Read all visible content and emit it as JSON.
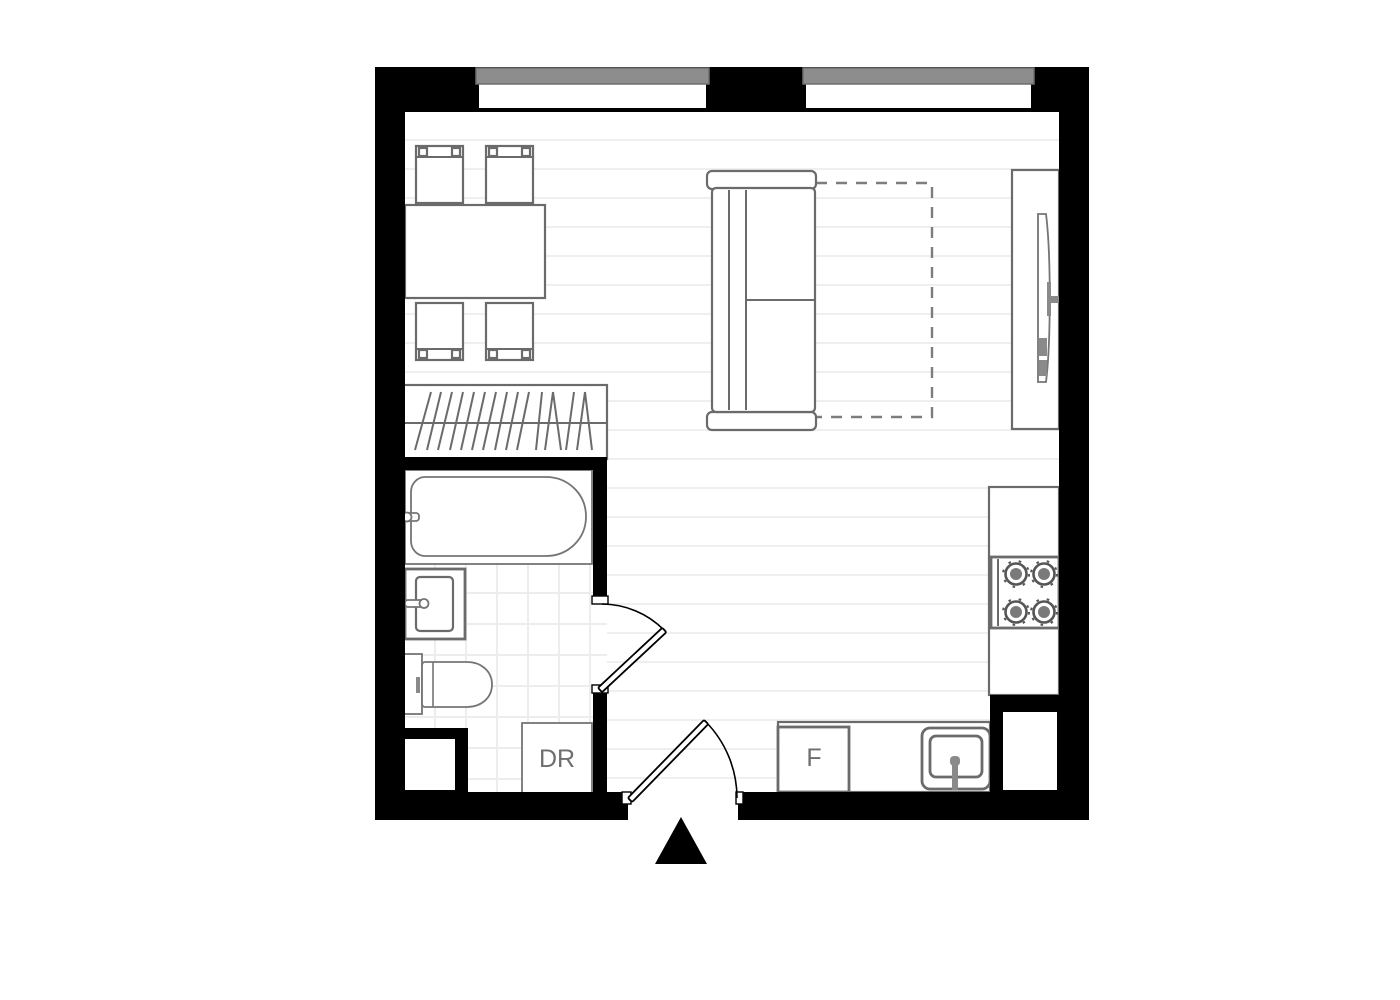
{
  "page": {
    "type": "studio apartment floor plan",
    "background": "#ffffff"
  },
  "labels": {
    "dresser": "DR",
    "fridge": "F"
  },
  "colors": {
    "wall": "#000000",
    "floor": "#ffffff",
    "glass": "#8d8d8d",
    "glassBorder": "#6f6f6f",
    "furniture": "#6b6b6b",
    "fixture": "#757575",
    "plank": "#efefef",
    "tile": "#ededed",
    "dashOutline": "#7d7d7d",
    "label": "#6e6e6e",
    "door": "#000000",
    "entranceMarker": "#000000"
  },
  "symbols": {
    "window": "gray glazing bar in wall opening",
    "sofa-bed-open-outline": "dashed rectangle",
    "closet-hangers": "diagonal hatch lines on rail",
    "stove-burner": "concentric circles with ticks",
    "entrance-marker": "filled triangle pointing up",
    "door-swing": "quarter-circle arc with leaf"
  }
}
